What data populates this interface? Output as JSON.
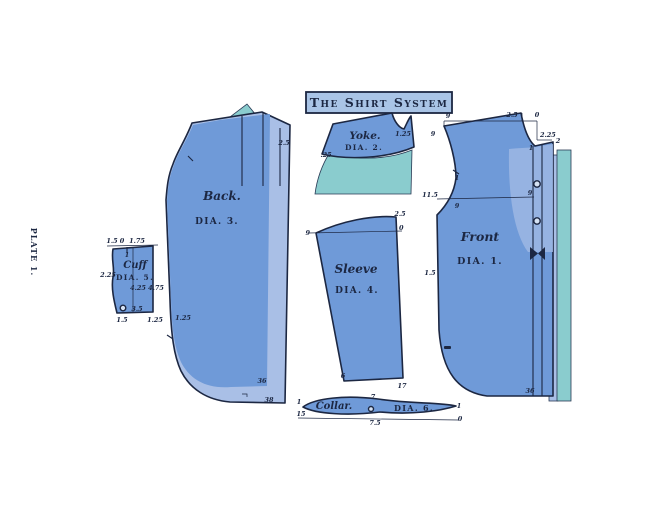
{
  "plate_label": "PLATE 1.",
  "title": "The Shirt System",
  "colors": {
    "main_blue": "#6f9ad8",
    "light_blue": "#a9bfe6",
    "teal": "#8accce",
    "outline_navy": "#1c2742",
    "title_fill": "#a9c4e6",
    "background": "#ffffff"
  },
  "pieces": {
    "front": {
      "name": "Front",
      "dia": "DIA. 1.",
      "m": {
        "top_nine": "9",
        "neck_width": "2.5",
        "zero": "0",
        "shoulder_nine": "9",
        "neck_depth": "2.25",
        "neck_point": "1",
        "band_width": "2",
        "armhole_notch": "1",
        "scye_depth": "11.5",
        "line_left_nine": "9",
        "line_right_nine": "9",
        "waist": "1.5",
        "hem": "36"
      }
    },
    "yoke": {
      "name": "Yoke.",
      "dia": "DIA. 2.",
      "m": {
        "right": "1.25",
        "left": ".25"
      }
    },
    "back": {
      "name": "Back.",
      "dia": "DIA. 3.",
      "m": {
        "pleat": "2.5",
        "side": "1.25",
        "hem_inner": "36",
        "hem_outer": "38"
      }
    },
    "sleeve": {
      "name": "Sleeve",
      "dia": "DIA. 4.",
      "m": {
        "cap": "2.5",
        "left_nine": "9",
        "zero": "0",
        "bottom_left": "6",
        "bottom_right": "17"
      }
    },
    "cuff": {
      "name": "Cuff",
      "dia": "DIA. 5.",
      "m": {
        "top_left": "1.5",
        "top_zero": "0",
        "top_right": "1.75",
        "one": "1",
        "mid_left": "2.25",
        "mid_center": "4.25",
        "mid_right": "4.75",
        "bottom_mid": "3.5",
        "bottom_left": "1.5",
        "bottom_right": "1.25"
      }
    },
    "collar": {
      "name": "Collar.",
      "dia": "DIA. 6.",
      "m": {
        "left_top": "1",
        "left_bottom": "15",
        "mid_top": "7",
        "mid_bottom": "7.5",
        "right_top": "1",
        "right_bottom": "0"
      }
    }
  }
}
